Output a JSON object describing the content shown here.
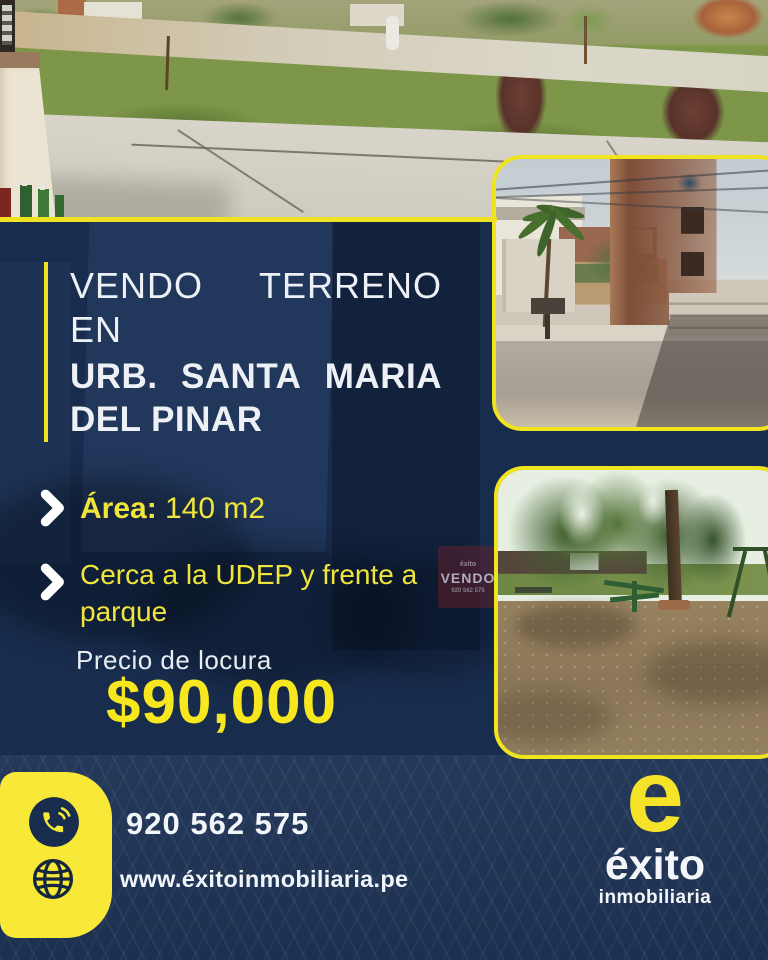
{
  "colors": {
    "navy": "#182c4d",
    "yellow": "#f0e41f",
    "white": "#f2f5f9"
  },
  "title": {
    "word1": "VENDO",
    "word2": "TERRENO",
    "line2": "EN",
    "line3_word1": "URB.",
    "line3_word2": "SANTA",
    "line3_word3": "MARIA",
    "line4": "DEL PINAR"
  },
  "features": [
    {
      "label": "Área:",
      "value": " 140 m2"
    },
    {
      "text": "Cerca a la UDEP y frente a parque"
    }
  ],
  "price": {
    "label": "Precio de locura",
    "value": "$90,000"
  },
  "contact": {
    "phone": "920 562 575",
    "website": "www.éxitoinmobiliaria.pe"
  },
  "brand": {
    "mark": "e",
    "name": "éxito",
    "descriptor": "inmobiliaria"
  },
  "background_sign": {
    "brand": "éxito",
    "title": "VENDO",
    "phone": "920 562 575"
  },
  "icons": {
    "phone": "phone-handset-icon",
    "globe": "globe-icon",
    "bullet": "chevron-right-icon"
  }
}
